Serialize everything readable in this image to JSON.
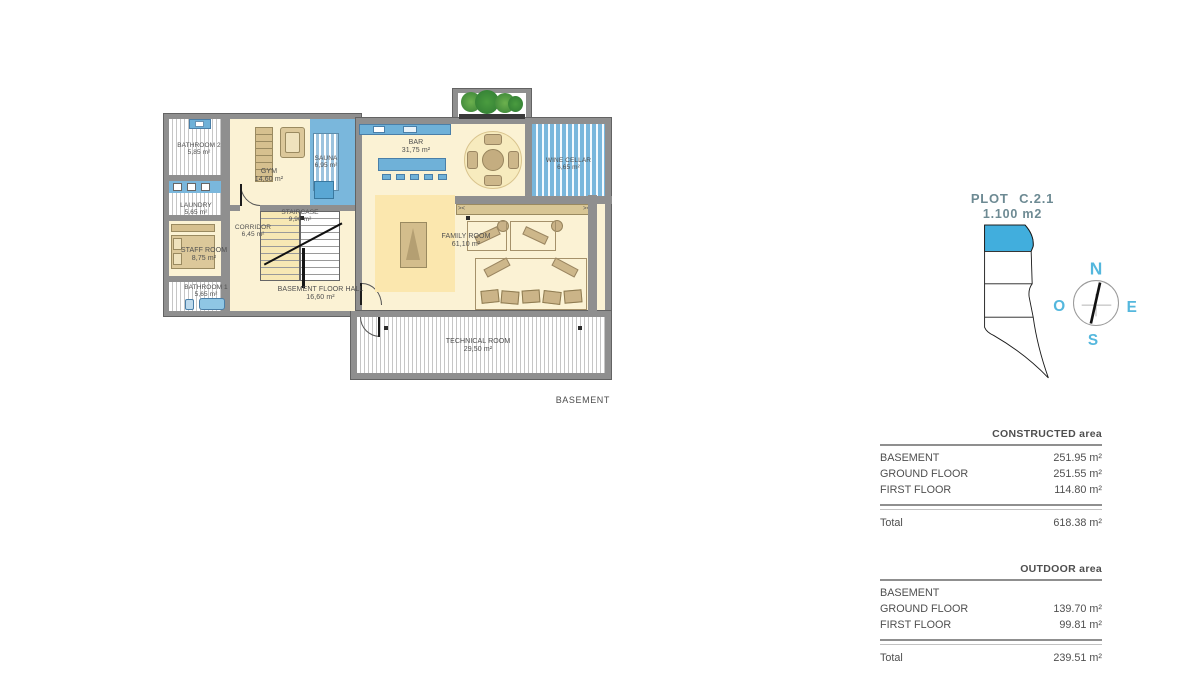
{
  "plan": {
    "floor_label": "BASEMENT",
    "rooms": [
      {
        "name": "BATHROOM 2",
        "area": "5,85 m²"
      },
      {
        "name": "GYM",
        "area": "14,60 m²"
      },
      {
        "name": "SAUNA",
        "area": "6,95 m²"
      },
      {
        "name": "BAR",
        "area": "31,75 m²"
      },
      {
        "name": "WINE CELLAR",
        "area": "6,65 m²"
      },
      {
        "name": "LAUNDRY",
        "area": "5,65 m²"
      },
      {
        "name": "CORRIDOR",
        "area": "6,45 m²"
      },
      {
        "name": "STAIRCASE",
        "area": "9,90 m²"
      },
      {
        "name": "STAFF ROOM",
        "area": "8,75 m²"
      },
      {
        "name": "BATHROOM 1",
        "area": "5,65 m²"
      },
      {
        "name": "BASEMENT FLOOR HALL",
        "area": "16,60 m²"
      },
      {
        "name": "FAMILY ROOM",
        "area": "61,10 m²"
      },
      {
        "name": "TECHNICAL ROOM",
        "area": "29,50 m²"
      }
    ]
  },
  "plot": {
    "title": "PLOT C.2.1",
    "area": "1.100 m2",
    "fill_color": "#41aedd"
  },
  "compass": {
    "n": "N",
    "e": "E",
    "s": "S",
    "o": "O",
    "letter_color": "#54b7dd"
  },
  "tables": {
    "constructed": {
      "header": "CONSTRUCTED area",
      "rows": [
        {
          "label": "BASEMENT",
          "value": "251.95 m²"
        },
        {
          "label": "GROUND FLOOR",
          "value": "251.55 m²"
        },
        {
          "label": "FIRST FLOOR",
          "value": "114.80 m²"
        }
      ],
      "total_label": "Total",
      "total_value": "618.38 m²"
    },
    "outdoor": {
      "header": "OUTDOOR area",
      "rows": [
        {
          "label": "BASEMENT",
          "value": ""
        },
        {
          "label": "GROUND FLOOR",
          "value": "139.70 m²"
        },
        {
          "label": "FIRST FLOOR",
          "value": "99.81 m²"
        }
      ],
      "total_label": "Total",
      "total_value": "239.51 m²"
    }
  }
}
